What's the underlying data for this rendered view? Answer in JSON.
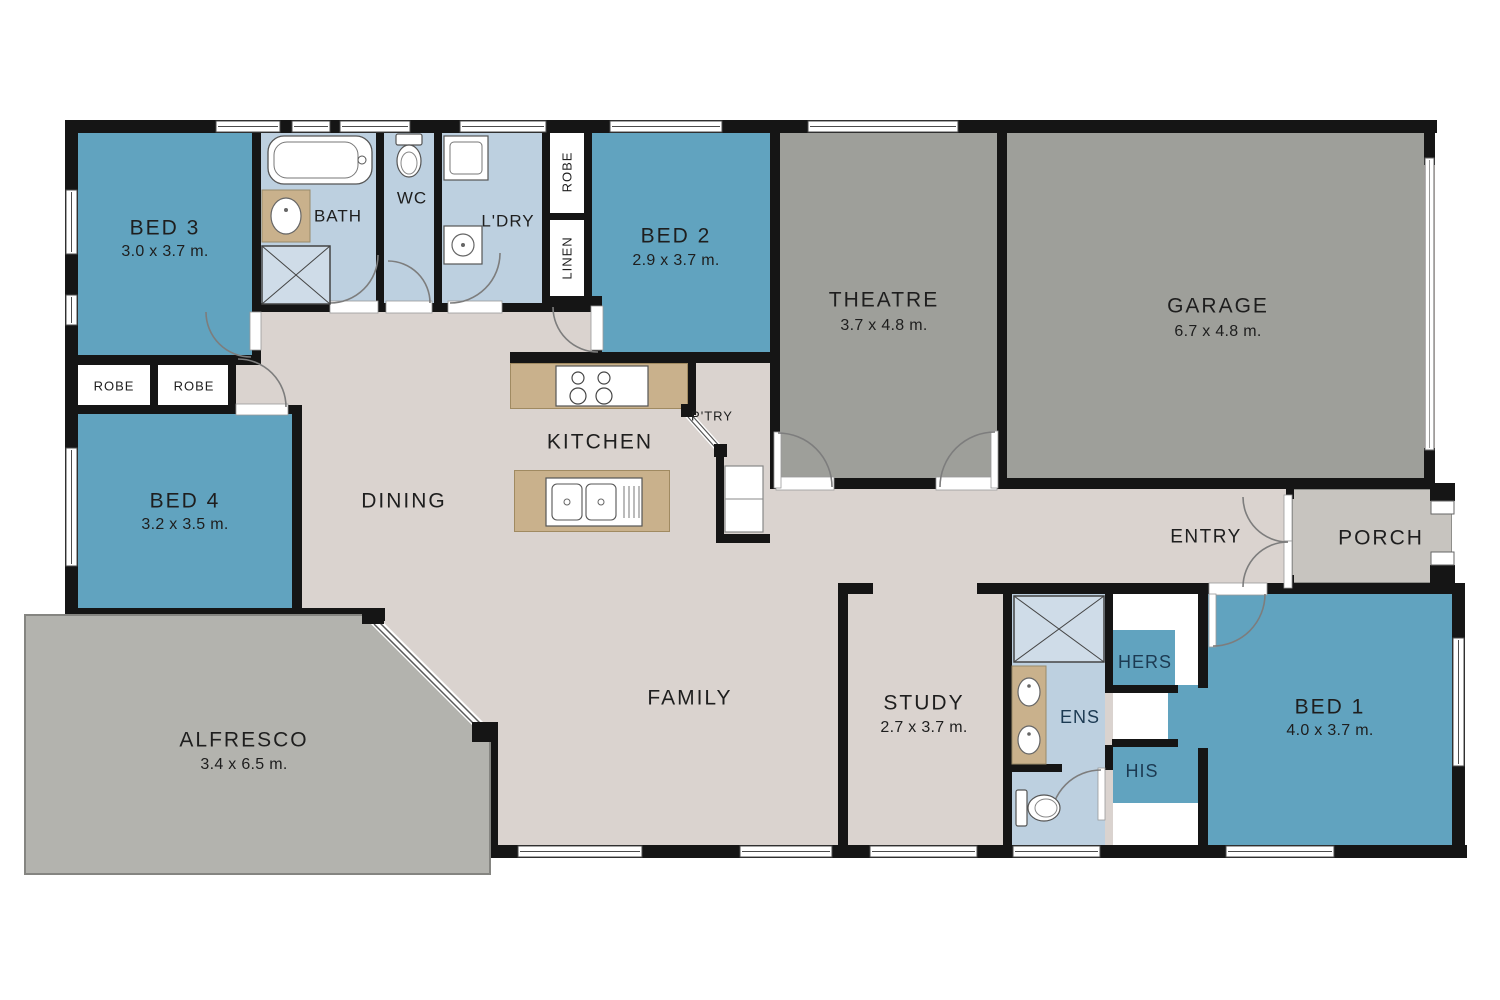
{
  "rooms": {
    "bed3": {
      "label": "BED 3",
      "dims": "3.0 x 3.7 m."
    },
    "bath": {
      "label": "BATH"
    },
    "wc": {
      "label": "WC"
    },
    "ldry": {
      "label": "L'DRY"
    },
    "robe_top": {
      "label": "ROBE"
    },
    "linen": {
      "label": "LINEN"
    },
    "bed2": {
      "label": "BED 2",
      "dims": "2.9 x 3.7 m."
    },
    "theatre": {
      "label": "THEATRE",
      "dims": "3.7 x 4.8 m."
    },
    "garage": {
      "label": "GARAGE",
      "dims": "6.7 x 4.8 m."
    },
    "robe1": {
      "label": "ROBE"
    },
    "robe2": {
      "label": "ROBE"
    },
    "bed4": {
      "label": "BED 4",
      "dims": "3.2 x 3.5 m."
    },
    "dining": {
      "label": "DINING"
    },
    "kitchen": {
      "label": "KITCHEN"
    },
    "ptry": {
      "label": "P'TRY"
    },
    "entry": {
      "label": "ENTRY"
    },
    "porch": {
      "label": "PORCH"
    },
    "alfresco": {
      "label": "ALFRESCO",
      "dims": "3.4 x 6.5 m."
    },
    "family": {
      "label": "FAMILY"
    },
    "study": {
      "label": "STUDY",
      "dims": "2.7 x 3.7 m."
    },
    "ens": {
      "label": "ENS"
    },
    "hers": {
      "label": "HERS"
    },
    "his": {
      "label": "HIS"
    },
    "bed1": {
      "label": "BED 1",
      "dims": "4.0 x 3.7 m."
    }
  },
  "colors": {
    "bedroom": "#61a3bf",
    "wet_area": "#bdd0e0",
    "theatre_garage": "#9e9f9a",
    "living_floor": "#dad3cf",
    "alfresco": "#b3b3ae",
    "porch": "#c7c4bf",
    "kitchen_bench": "#c9b18c",
    "wall": "#151515"
  }
}
